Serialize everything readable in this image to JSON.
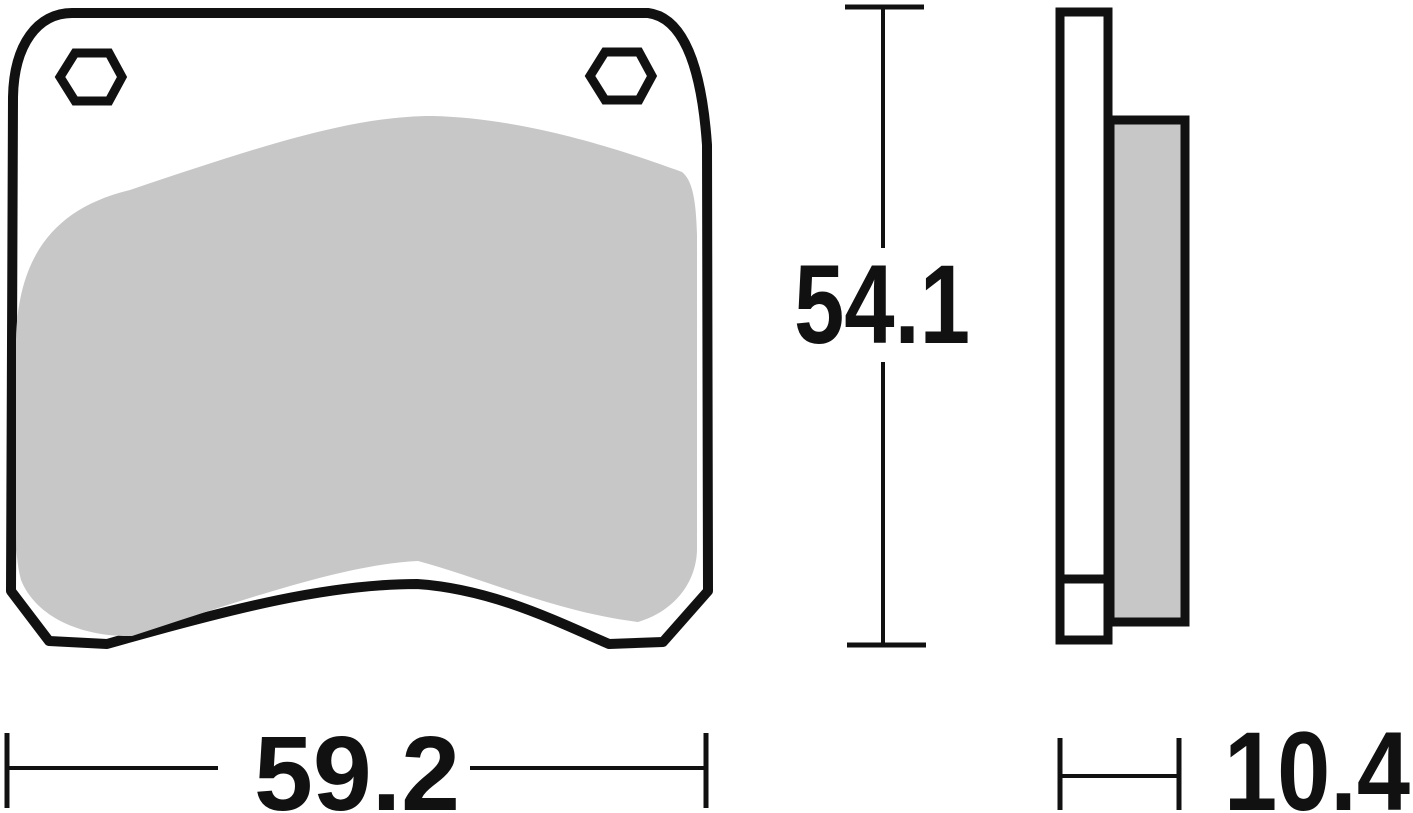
{
  "dimensions": {
    "height": {
      "value": "54.1"
    },
    "width": {
      "value": "59.2"
    },
    "thickness": {
      "value": "10.4"
    }
  },
  "colors": {
    "line": "#111111",
    "friction_material": "#c7c7c7",
    "background": "#ffffff"
  }
}
